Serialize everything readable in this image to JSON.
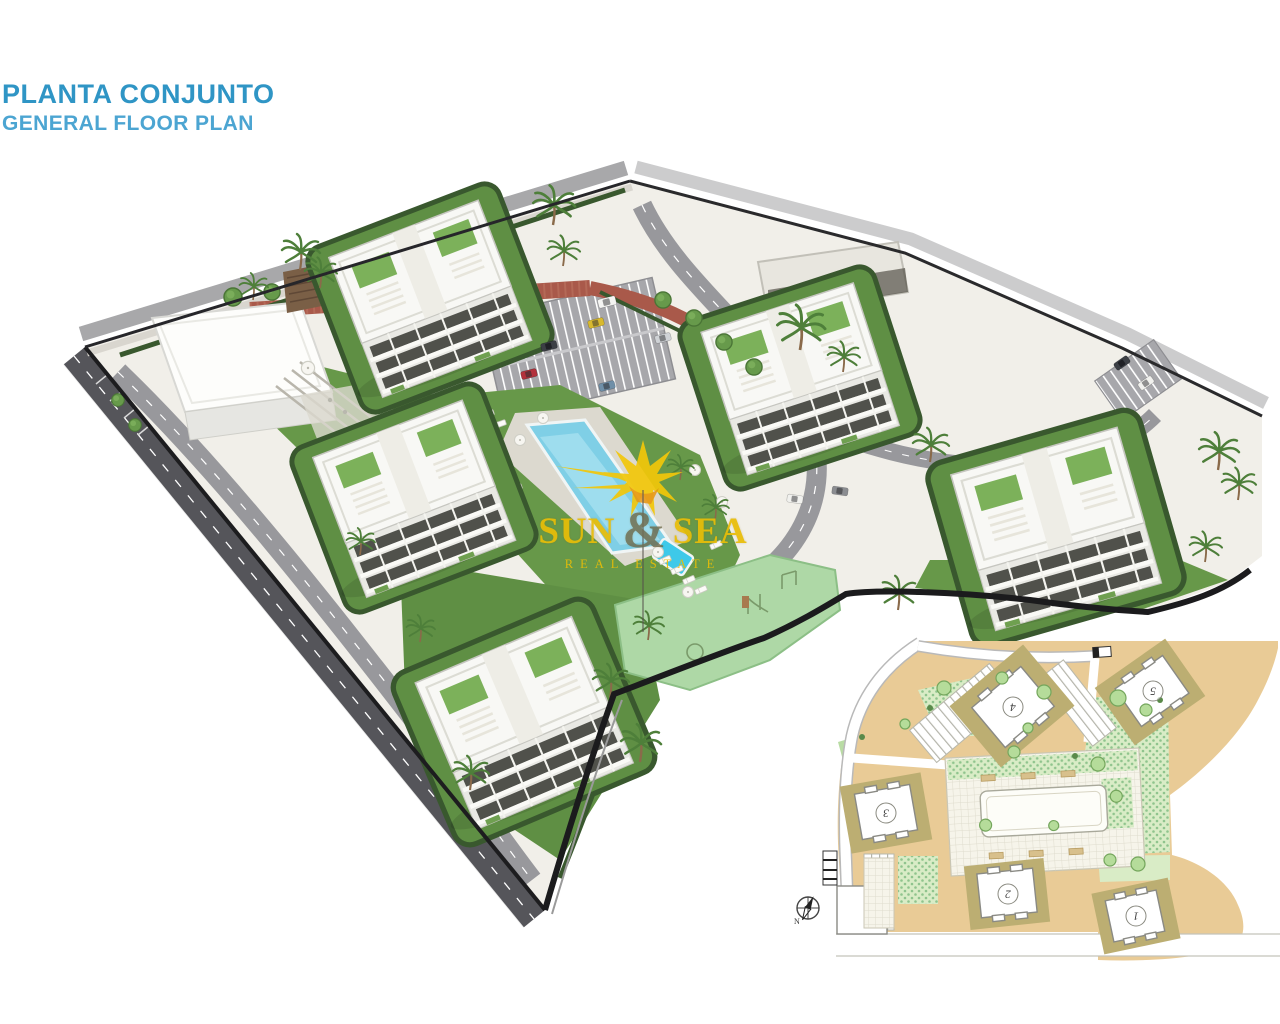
{
  "page": {
    "background": "#ffffff"
  },
  "header": {
    "title_primary": "PLANTA CONJUNTO",
    "title_secondary": "GENERAL FLOOR PLAN",
    "title_primary_color": "#2f95c5",
    "title_secondary_color": "#4ca5d2"
  },
  "watermark": {
    "brand_word1": "SUN",
    "brand_ampersand": "&",
    "brand_word2": "SEA",
    "brand_tagline": "REAL ESTATE",
    "brand_color": "#e9bd07",
    "sun_icon": "sunburst-icon"
  },
  "render": {
    "colors": {
      "ground": "#f1efe9",
      "lawn_green": "#679849",
      "hedge_green": "#39582e",
      "pool_water": "#7fcfe6",
      "kids_pool": "#3ec9e9",
      "playground_green": "#aed8a6",
      "brick_path_red": "#a9594a",
      "perimeter_road": "#55555a",
      "interior_road": "#9b9b9f",
      "building_white": "#f8f8f5",
      "window_dark": "#50514b"
    }
  },
  "site_plan_inset": {
    "building_labels": [
      "1",
      "2",
      "3",
      "4",
      "5"
    ],
    "compass_north_label": "N",
    "colors": {
      "land_tan": "#e9cb96",
      "building_pad_olive": "#bcae72",
      "lawn_light_green": "#d9ecc6",
      "road_white": "#ffffff"
    }
  }
}
